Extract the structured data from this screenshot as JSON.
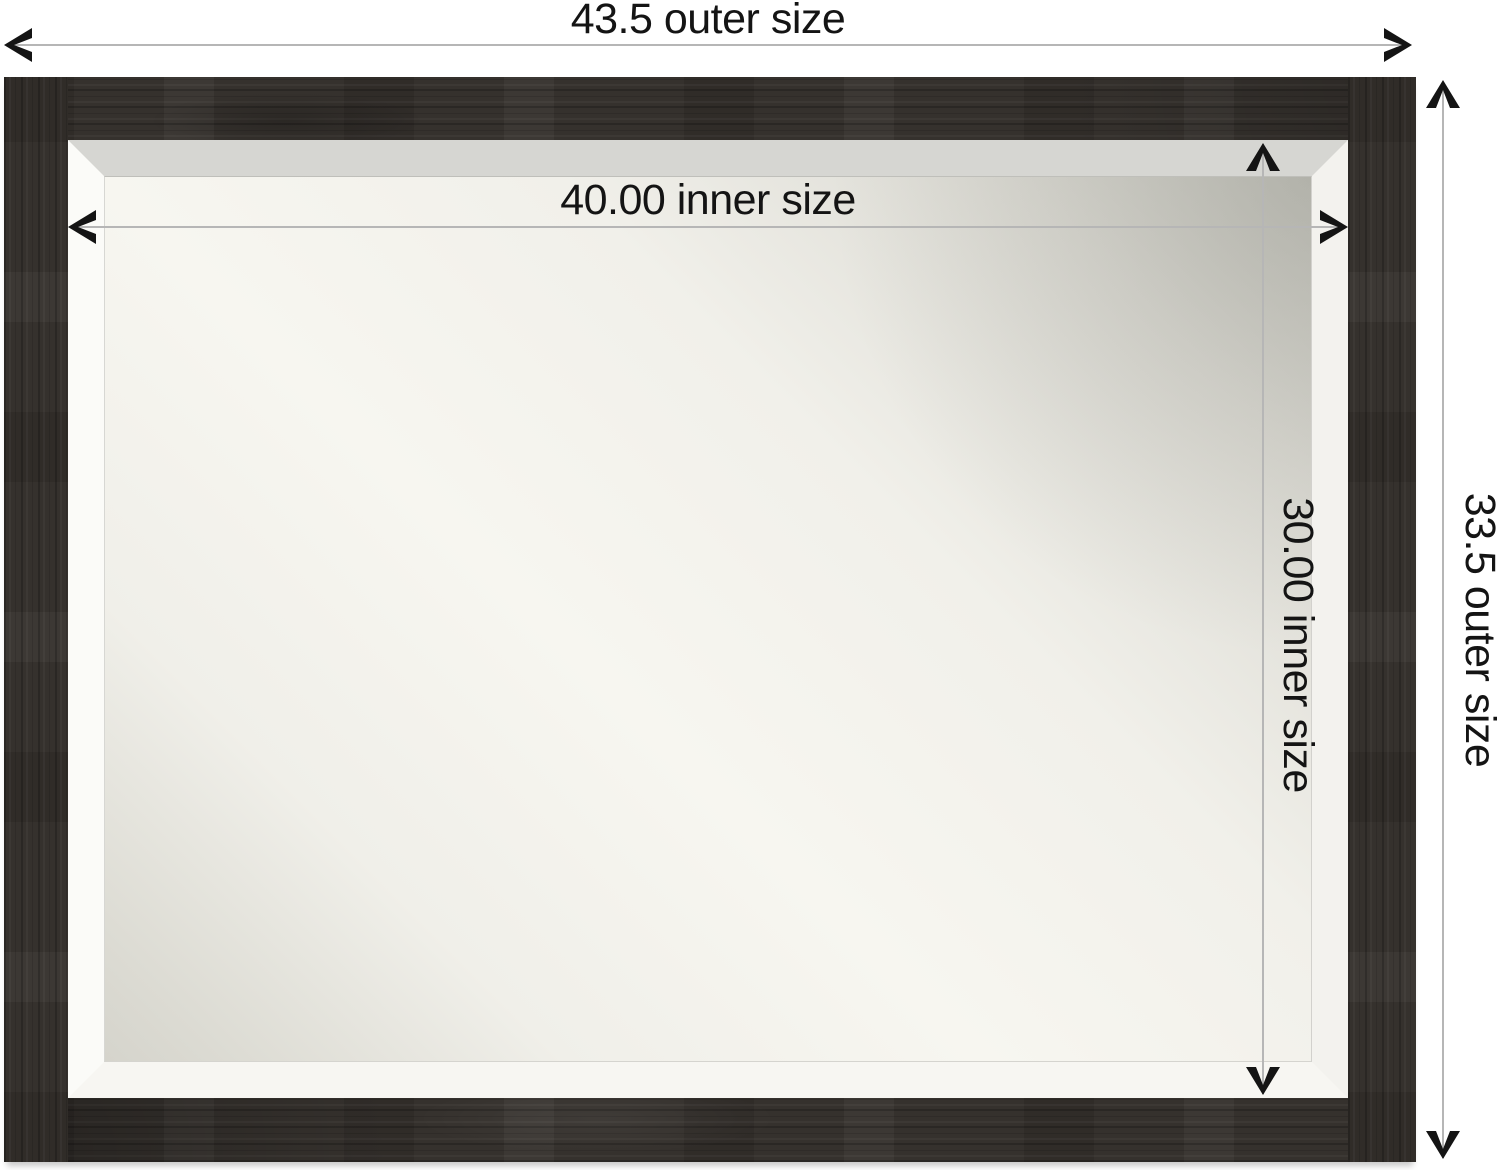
{
  "image_type": "product-dimension-diagram",
  "product": {
    "name": "rustic-framed-beveled-wall-mirror",
    "frame_color": "#35312d",
    "bevel_color": "#f7f6f2",
    "mirror_center_color": "#f7f6f0",
    "mirror_edge_color": "#c9c9c1",
    "background_color": "#ffffff"
  },
  "annotations": {
    "line_color": "#b6b6b6",
    "arrow_color": "#141414",
    "text_color": "#141414",
    "outer_width": {
      "label": "43.5 outer size",
      "value": 43.5
    },
    "inner_width": {
      "label": "40.00 inner size",
      "value": 40.0
    },
    "inner_height": {
      "label": "30.00 inner size",
      "value": 30.0
    },
    "outer_height": {
      "label": "33.5 outer size",
      "value": 33.5
    }
  }
}
